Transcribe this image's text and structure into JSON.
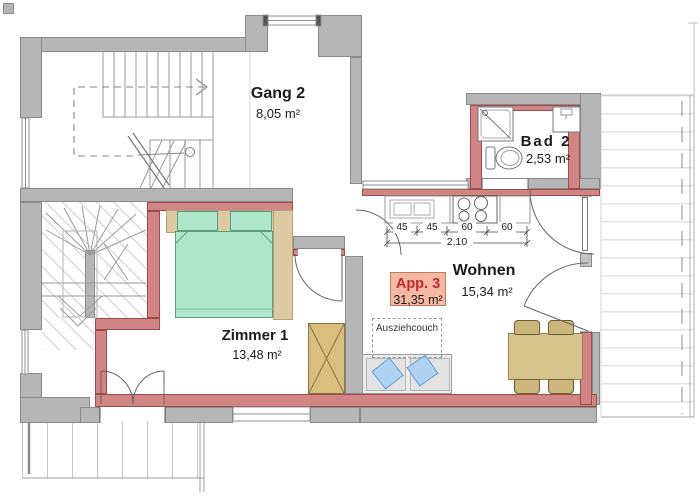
{
  "rooms": {
    "gang": {
      "name": "Gang 2",
      "area": "8,05 m²"
    },
    "bad": {
      "name": "Bad 2",
      "area": "2,53 m²"
    },
    "zimmer": {
      "name": "Zimmer 1",
      "area": "13,48 m²"
    },
    "wohnen": {
      "name": "Wohnen",
      "area": "15,34 m²"
    }
  },
  "badge": {
    "label": "App. 3",
    "area": "31,35 m²"
  },
  "annotations": {
    "couch": "Ausziehcouch"
  },
  "kitchen_dims": {
    "s1": "45",
    "s2": "45",
    "s3": "60",
    "s4": "60",
    "total": "2,10"
  },
  "colors": {
    "wall": "#b6b6b6",
    "wall_line": "#8a8a8a",
    "red": "#d28585",
    "red_line": "#9d4a4a",
    "mint": "#aee6cc",
    "mint_line": "#5f9c7e",
    "tan": "#dccaa2",
    "tan_line": "#b3a379",
    "wood": "#d9be7e",
    "wood_line": "#8a7440",
    "tbl": "#d7c38c",
    "tbl_line": "#97804a",
    "chair": "#cbb67c",
    "chair_line": "#6b5d30",
    "couch": "#ececec",
    "couch_line": "#9a9a9a",
    "pillow": "#aed2f2",
    "pillow_line": "#6b9dd0",
    "badge_bg": "#f5b9a2",
    "badge_border": "#c07a62",
    "badge_text": "#c2272d"
  }
}
